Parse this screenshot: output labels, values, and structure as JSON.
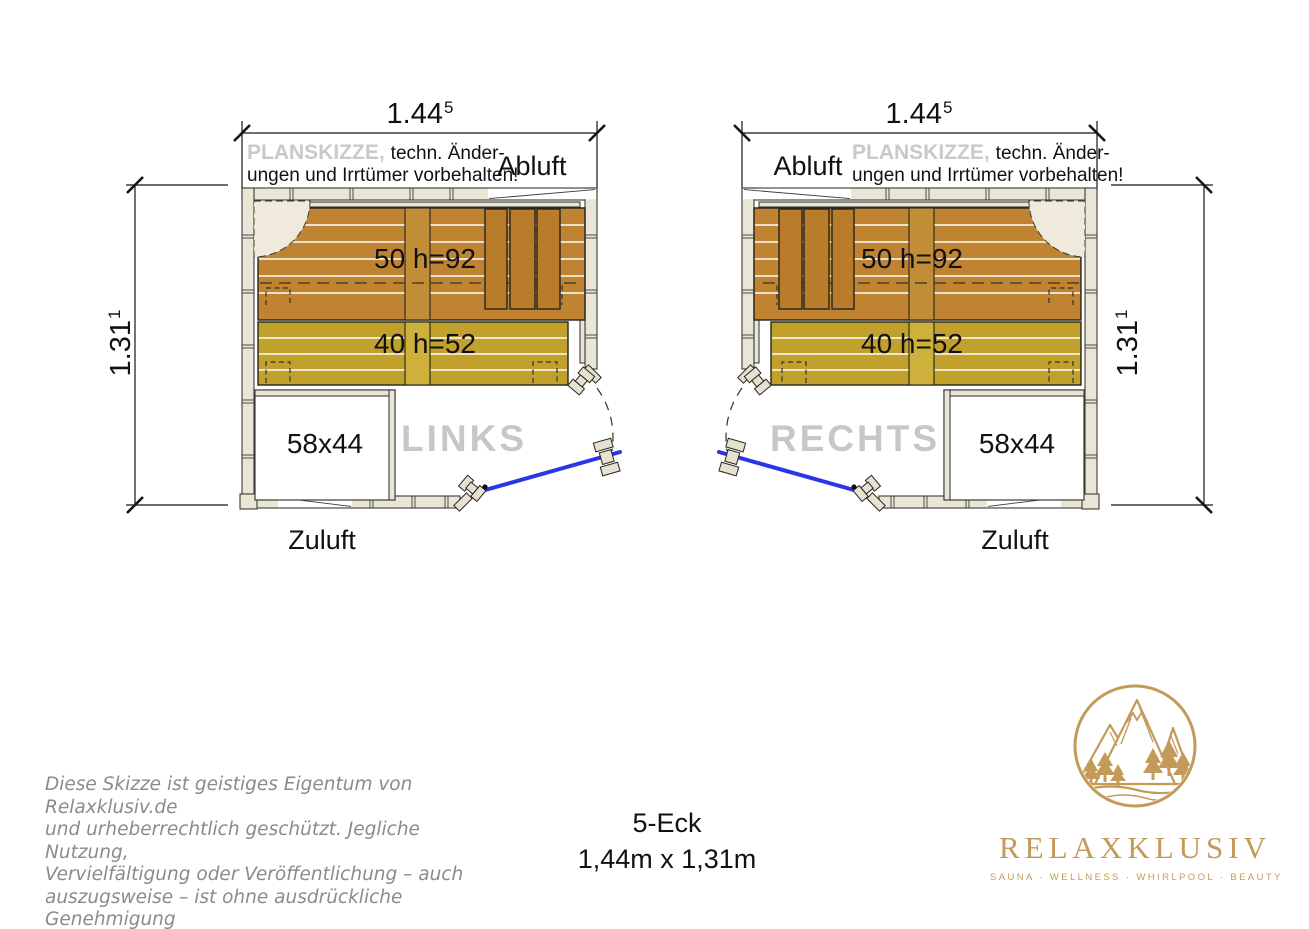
{
  "plans": {
    "shared": {
      "width_value": "1.44",
      "width_sup": "5",
      "height_value": "1.31",
      "height_sup": "1",
      "planskizze_bold": "PLANSKIZZE,",
      "planskizze_rest": "techn. Änder-",
      "planskizze_line2": "ungen und Irrtümer vorbehalten!",
      "abluft_label": "Abluft",
      "zuluft_label": "Zuluft",
      "upper_bench_label": "50 h=92",
      "lower_bench_label": "40 h=52",
      "heater_label": "58x44"
    },
    "left": {
      "watermark": "LINKS"
    },
    "right": {
      "watermark": "RECHTS"
    }
  },
  "footer": {
    "copyright_lines": [
      "Diese Skizze ist geistiges Eigentum von Relaxklusiv.de",
      "und urheberrechtlich geschützt. Jegliche Nutzung,",
      "Vervielfältigung oder Veröffentlichung – auch",
      "auszugsweise – ist ohne ausdrückliche Genehmigung",
      "nicht erlaubt."
    ],
    "model_label": "5-Eck",
    "dimensions_label": "1,44m x 1,31m"
  },
  "logo": {
    "brand": "RELAXKLUSIV",
    "tagline": "SAUNA · WELLNESS · WHIRLPOOL · BEAUTY"
  },
  "colors": {
    "upper_bench": "#c08331",
    "lower_bench": "#c1a02b",
    "wall_wood": "#e9e5d7",
    "door_glass_blue": "#2a35e8",
    "watermark_gray": "#c7c7c7",
    "planskizze_gray": "#c9c9c9",
    "logo_gold": "#c49a58",
    "ink": "#1a1a1a"
  }
}
